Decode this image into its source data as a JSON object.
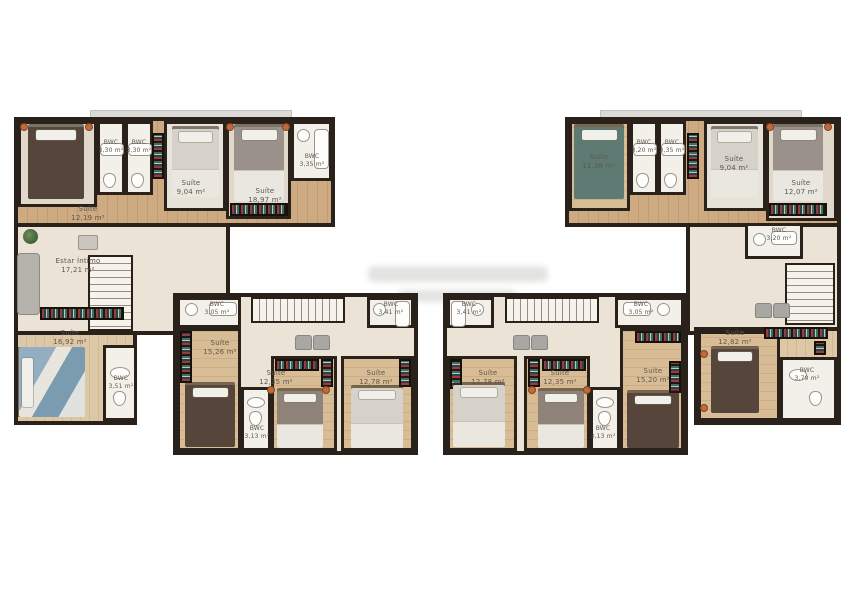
{
  "colors": {
    "wall": "#2a211a",
    "wood_floor": "#c9a67e",
    "hall_floor": "#eae3d6",
    "bath_floor": "#f3f0ea",
    "carpet_floor": "#e0d9cb",
    "label_text": "#5f584e",
    "background": "#ffffff"
  },
  "plans": [
    {
      "id": "top-left",
      "rooms": [
        {
          "name": "Suíte",
          "area": "12,19 m²"
        },
        {
          "name": "BWC",
          "area": "3,30 m²"
        },
        {
          "name": "BWC",
          "area": "3,30 m²"
        },
        {
          "name": "Suíte",
          "area": "9,04 m²"
        },
        {
          "name": "Suíte",
          "area": "18,97 m²"
        },
        {
          "name": "BWC",
          "area": "3,35 m²"
        },
        {
          "name": "Estar Íntimo",
          "area": "17,21 m²"
        },
        {
          "name": "Suíte",
          "area": "16,92 m²"
        },
        {
          "name": "BWC",
          "area": "3,51 m²"
        }
      ]
    },
    {
      "id": "top-right",
      "rooms": [
        {
          "name": "Suíte",
          "area": "11,38 m²"
        },
        {
          "name": "BWC",
          "area": "3,20 m²"
        },
        {
          "name": "BWC",
          "area": "3,35 m²"
        },
        {
          "name": "Suíte",
          "area": "9,04 m²"
        },
        {
          "name": "Suíte",
          "area": "12,07 m²"
        },
        {
          "name": "BWC",
          "area": "3,20 m²"
        },
        {
          "name": "Suíte",
          "area": "12,82 m²"
        },
        {
          "name": "BWC",
          "area": "3,79 m²"
        }
      ]
    },
    {
      "id": "bottom-left",
      "rooms": [
        {
          "name": "BWC",
          "area": "3,05 m²"
        },
        {
          "name": "BWC",
          "area": "3,41 m²"
        },
        {
          "name": "Suíte",
          "area": "15,26 m²"
        },
        {
          "name": "Suíte",
          "area": "12,35 m²"
        },
        {
          "name": "BWC",
          "area": "3,13 m²"
        },
        {
          "name": "Suíte",
          "area": "12,78 m²"
        }
      ]
    },
    {
      "id": "bottom-right",
      "rooms": [
        {
          "name": "BWC",
          "area": "3,41 m²"
        },
        {
          "name": "BWC",
          "area": "3,05 m²"
        },
        {
          "name": "Suíte",
          "area": "12,78 m²"
        },
        {
          "name": "Suíte",
          "area": "12,35 m²"
        },
        {
          "name": "BWC",
          "area": "3,13 m²"
        },
        {
          "name": "Suíte",
          "area": "15,20 m²"
        }
      ]
    }
  ]
}
